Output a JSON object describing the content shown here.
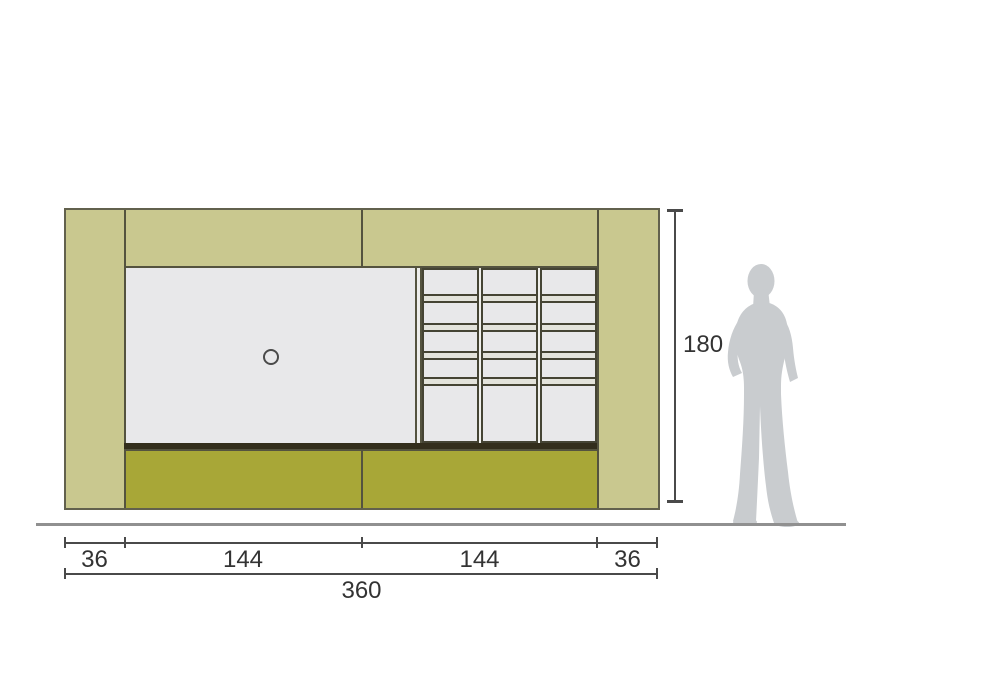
{
  "diagram": {
    "type": "furniture-elevation-drawing",
    "dimensions": {
      "height": "180",
      "total_width": "360",
      "segments": [
        "36",
        "144",
        "144",
        "36"
      ]
    },
    "shelf_grid": {
      "columns": 3,
      "rows_per_column": 5
    },
    "colors": {
      "khaki_panel": "#c9c88f",
      "olive_base": "#a8a737",
      "gray_panel": "#e8e8ea",
      "outline_dark": "#54533f",
      "shelf_dark": "#332e1c",
      "dimension_line": "#4a4a4a",
      "label_text": "#333333",
      "ground_line": "#909090",
      "figure_gray": "#c9cccf"
    }
  }
}
